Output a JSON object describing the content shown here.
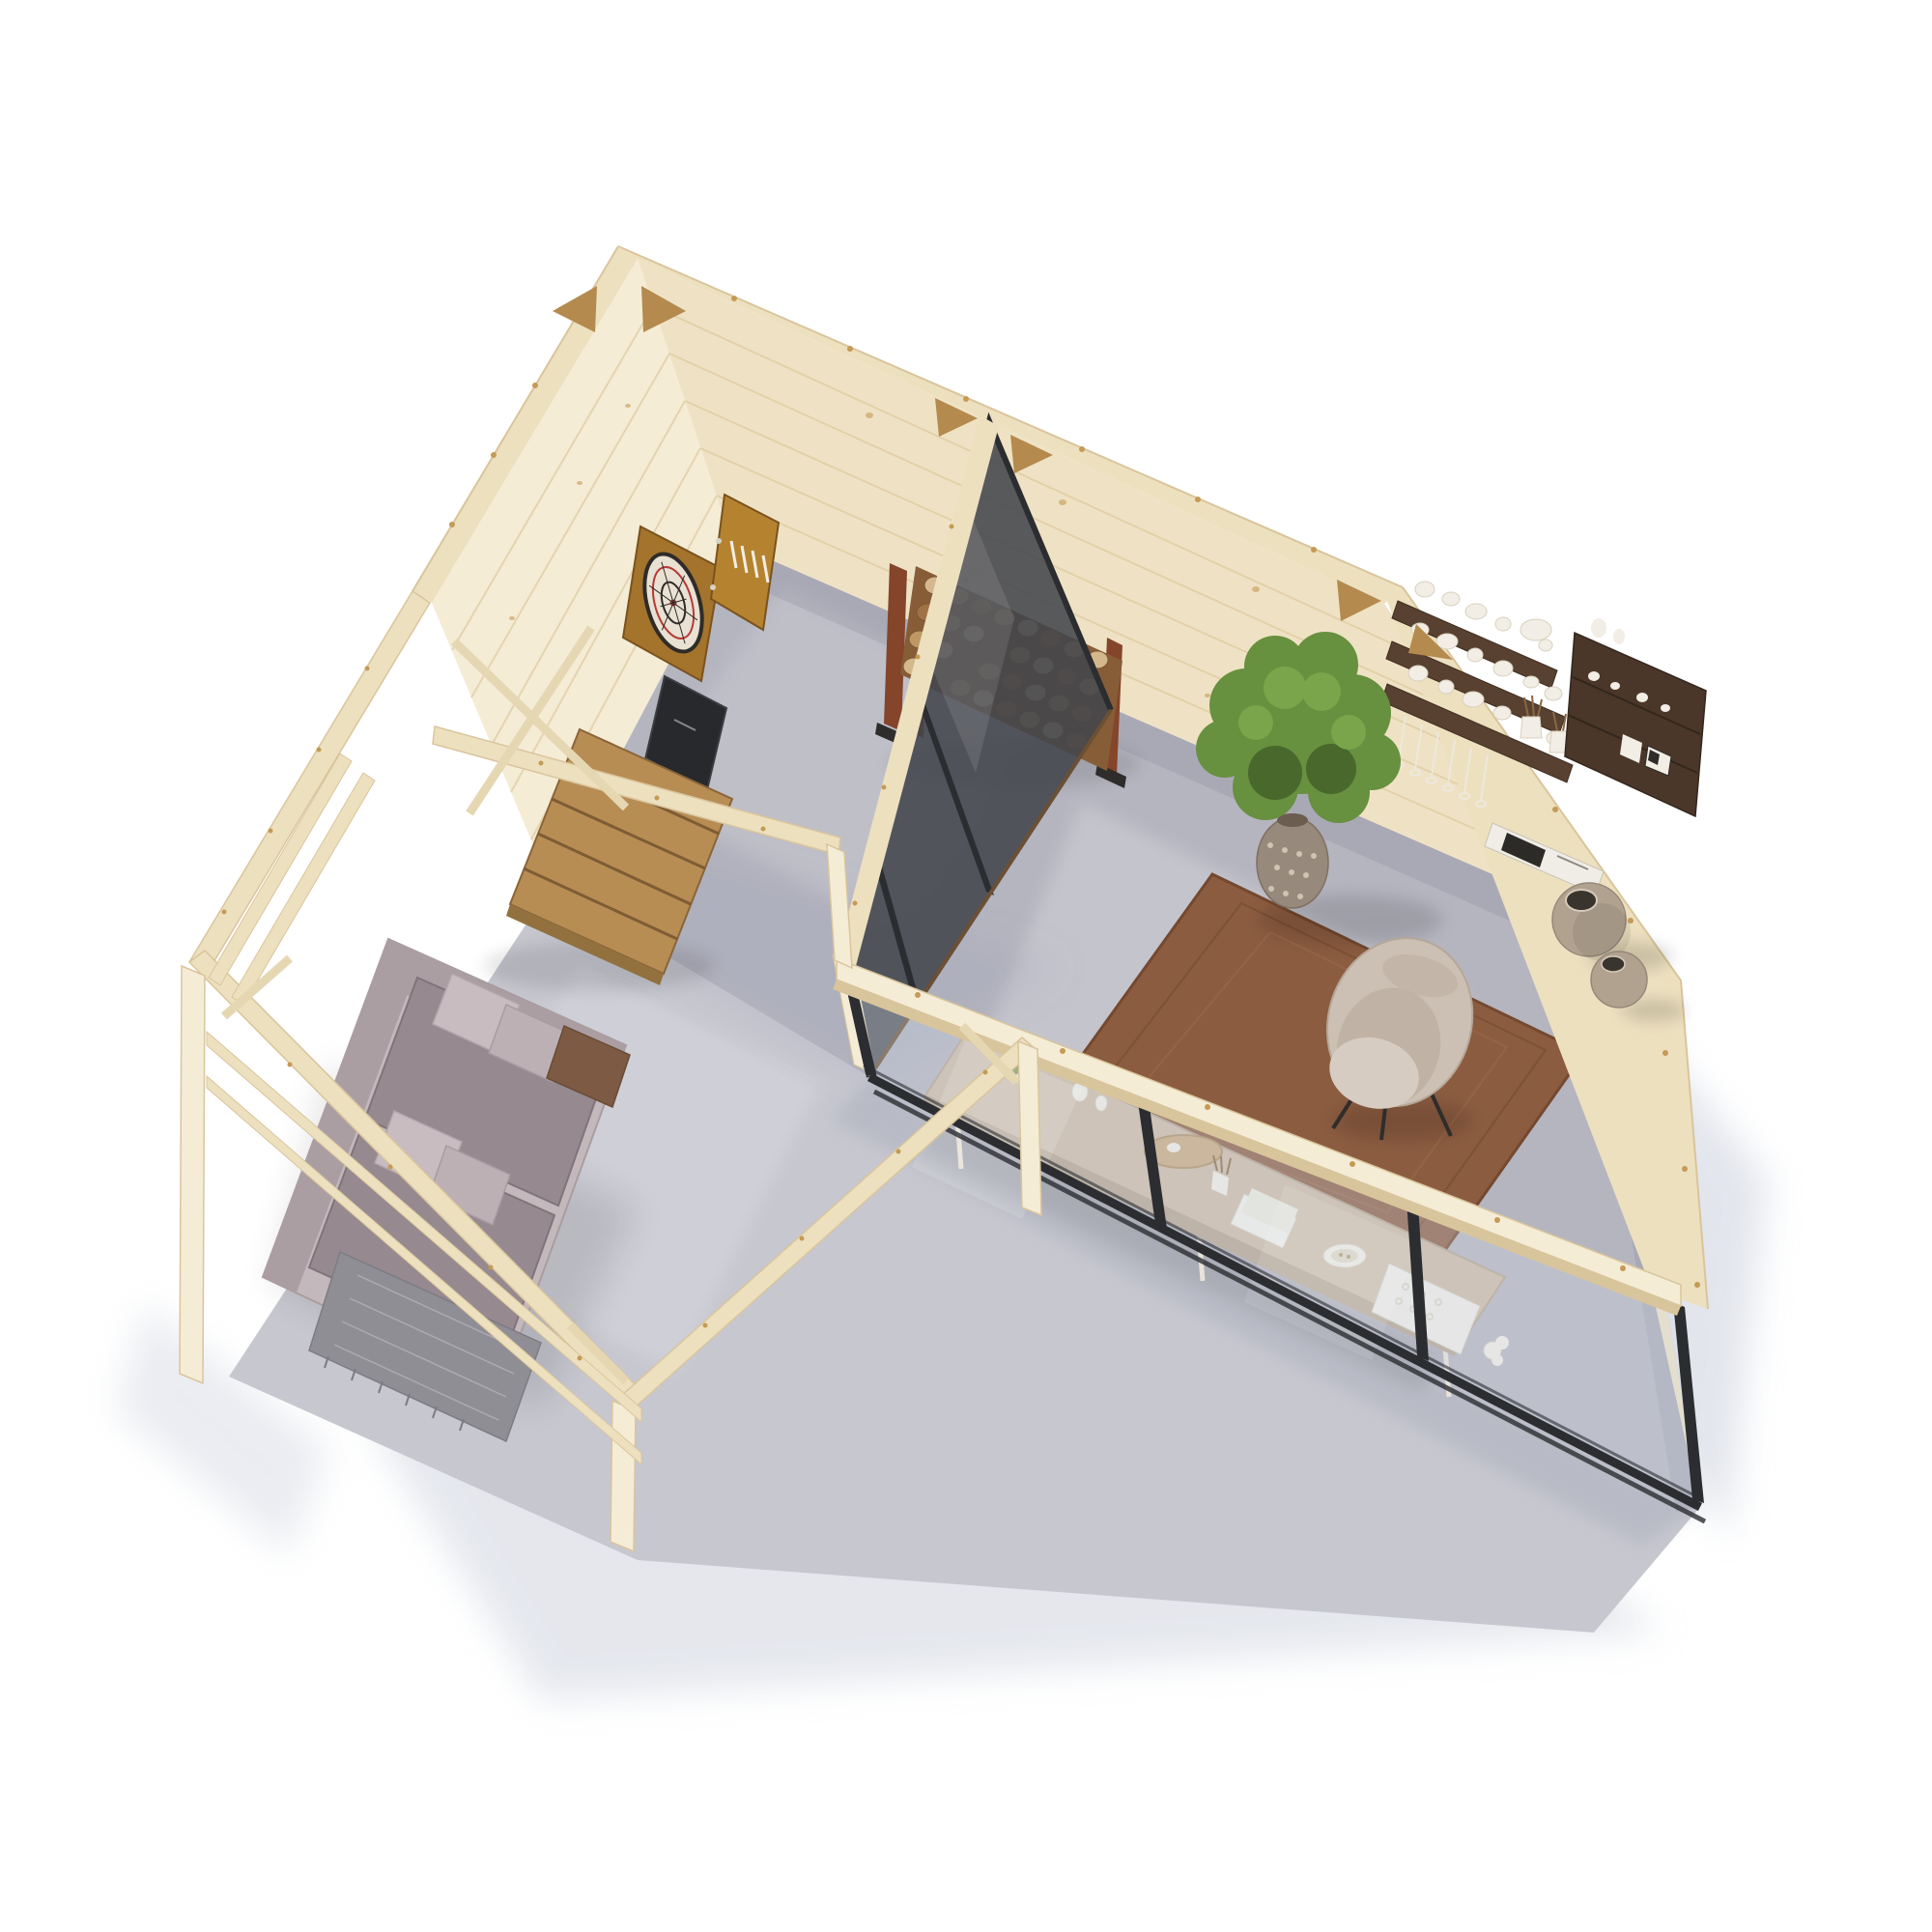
{
  "scene": {
    "title": "Aerial 3D render of an L-shaped wooden garden house with games room, glazed garden office and covered pergola terrace",
    "view": "top-down axonometric cutaway without roof",
    "background": "#ffffff"
  },
  "palette": {
    "wall_wood": "#efe2c4",
    "wall_wood_light": "#f5ecd6",
    "wall_cap": "#ede0bf",
    "wall_edge": "#d9c59c",
    "wood_grain": "#ddca9f",
    "knot_brown": "#c59a55",
    "brace_tan": "#b48a4e",
    "floor_concrete": "#b5b5c0",
    "terrace_concrete": "#c7c7d0",
    "ground_shadow": "#ccd1dd",
    "glass_frame_black": "#2b2d31",
    "glass_tint": "#cdd7e4",
    "partition_glass_dark": "#43464c",
    "bronze_track": "#6b5034",
    "rug_brown": "#8b5c40",
    "rug_brown_dark": "#74492f",
    "rug_brown_light": "#9d6c4d",
    "sofa_base": "#c3b8bb",
    "sofa_back": "#ab9ea3",
    "sofa_cushion": "#968a90",
    "pillow_light": "#c8bcc0",
    "pillow_light2": "#bdb0b5",
    "pillow_brown": "#7c5a43",
    "throw_gray": "#8f8e94",
    "throw_line": "#b8b7bd",
    "table_oak": "#b78d54",
    "table_gap": "#7e5c34",
    "table_edge": "#92713f",
    "log_light": "#d4b88c",
    "log_mid": "#bd9764",
    "log_dark": "#a07246",
    "log_deep": "#875d38",
    "rack_post_brown": "#84452a",
    "rack_foot_black": "#2e2d2b",
    "dartboard_frame": "#a4732c",
    "dartboard_door": "#b5832f",
    "dartboard_cream": "#e9e1d3",
    "dartboard_black": "#2f2c28",
    "dartboard_red": "#b43a35",
    "chalkboard_black": "#27292d",
    "plant_green": "#67903f",
    "plant_green_dark": "#49682c",
    "plant_green_light": "#7aa54b",
    "planter_taupe": "#97897b",
    "planter_dot": "#cfc3b2",
    "shelf_walnut": "#584130",
    "cabinet_walnut": "#4a372a",
    "ceramic_white": "#f2eee5",
    "desk_wood": "#cdbaa4",
    "desk_edge": "#b5a28c",
    "desk_leg": "#e8e2d8",
    "chair_beige": "#ccc0b4",
    "chair_seat": "#c0b2a4",
    "leg_black": "#2f2d2b",
    "floor_vase_taupe": "#b1a290",
    "vase_opening": "#39342d"
  },
  "building": {
    "structure": [
      "pale pine log walls with top plates and corner braces",
      "black-framed glazed front wall with sliding panels",
      "black-framed glass sliding partition between rooms",
      "open pergola frame with posts and side railing over terrace"
    ],
    "rooms": [
      {
        "id": "games-room",
        "label": "Games room",
        "floor": "grey concrete",
        "items": [
          "wall dartboard cabinet with open door and darts",
          "black chalk scoreboard",
          "firewood storage rack with stacked split logs"
        ]
      },
      {
        "id": "garden-office",
        "label": "Garden office",
        "floor": "grey concrete",
        "items": [
          "large potted green shrub in patterned vase",
          "walnut wall shelves with white ceramics",
          "hanging stemware glasses",
          "walnut display cabinet",
          "leaning black-and-white art prints",
          "desk with plant, tray, pencil cup, notebooks, bowl and white decor",
          "beige upholstered desk chair",
          "brown woven jute rug",
          "two round taupe floor vases"
        ]
      },
      {
        "id": "terrace",
        "label": "Covered terrace",
        "floor": "concrete slab",
        "items": [
          "pergola posts, beams and diagonal braces",
          "double side railing",
          "outdoor sofa with mauve-grey cushions",
          "light scatter pillows and brown velvet pillow",
          "grey herringbone throw blanket",
          "slatted oak coffee table"
        ]
      }
    ]
  }
}
